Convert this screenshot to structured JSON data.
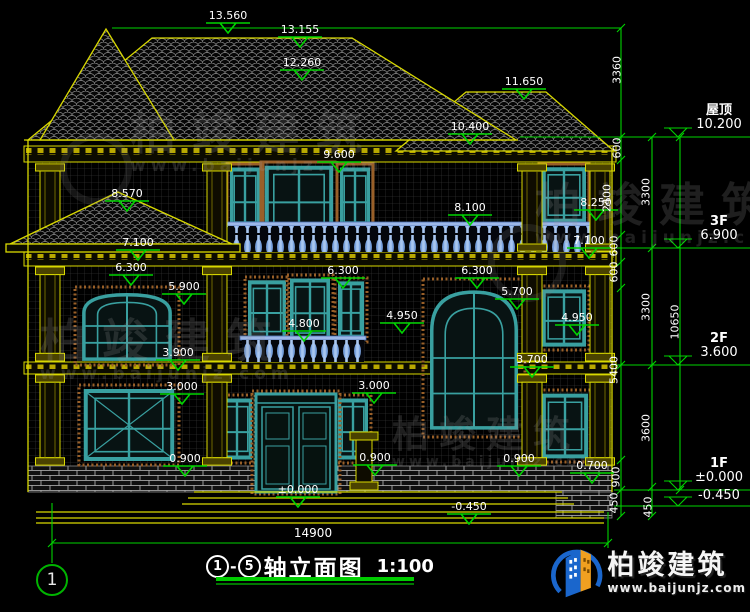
{
  "title_block": {
    "axis_start": "1",
    "axis_end": "5",
    "axis_separator": "-",
    "title": "轴立面图",
    "scale": "1:100",
    "axis_bubble": "1",
    "overall_width_dim": "14900"
  },
  "brand": {
    "name": "柏竣建筑",
    "website": "www.baijunjz.com"
  },
  "watermark": {
    "name": "柏竣建筑",
    "website": "www.baijunjz.com"
  },
  "levels": [
    {
      "name": "屋顶",
      "value": "10.200",
      "y": 137
    },
    {
      "name": "3F",
      "value": "6.900",
      "y": 248
    },
    {
      "name": "2F",
      "value": "3.600",
      "y": 365
    },
    {
      "name": "1F",
      "value": "±0.000",
      "y": 490
    },
    {
      "name": "",
      "value": "-0.450",
      "y": 506
    }
  ],
  "elevation_markers": [
    {
      "t": "13.560",
      "x": 228,
      "y": 10
    },
    {
      "t": "13.155",
      "x": 300,
      "y": 24
    },
    {
      "t": "12.260",
      "x": 302,
      "y": 57
    },
    {
      "t": "11.650",
      "x": 524,
      "y": 76
    },
    {
      "t": "10.400",
      "x": 470,
      "y": 121
    },
    {
      "t": "9.600",
      "x": 339,
      "y": 149
    },
    {
      "t": "8.570",
      "x": 127,
      "y": 188
    },
    {
      "t": "8.250",
      "x": 596,
      "y": 197
    },
    {
      "t": "8.100",
      "x": 470,
      "y": 202
    },
    {
      "t": "7.100",
      "x": 138,
      "y": 237
    },
    {
      "t": "7.100",
      "x": 589,
      "y": 235
    },
    {
      "t": "6.300",
      "x": 131,
      "y": 262
    },
    {
      "t": "6.300",
      "x": 343,
      "y": 265
    },
    {
      "t": "6.300",
      "x": 477,
      "y": 265
    },
    {
      "t": "5.900",
      "x": 184,
      "y": 281
    },
    {
      "t": "5.700",
      "x": 517,
      "y": 286
    },
    {
      "t": "4.950",
      "x": 402,
      "y": 310
    },
    {
      "t": "4.950",
      "x": 577,
      "y": 312
    },
    {
      "t": "4.800",
      "x": 304,
      "y": 318
    },
    {
      "t": "3.900",
      "x": 178,
      "y": 347
    },
    {
      "t": "3.700",
      "x": 532,
      "y": 354
    },
    {
      "t": "3.000",
      "x": 182,
      "y": 381
    },
    {
      "t": "3.000",
      "x": 374,
      "y": 380
    },
    {
      "t": "0.900",
      "x": 185,
      "y": 453
    },
    {
      "t": "0.900",
      "x": 375,
      "y": 452
    },
    {
      "t": "0.900",
      "x": 519,
      "y": 453
    },
    {
      "t": "0.700",
      "x": 592,
      "y": 460
    },
    {
      "t": "±0.000",
      "x": 298,
      "y": 484
    },
    {
      "t": "-0.450",
      "x": 469,
      "y": 501
    }
  ],
  "vertical_dims": [
    {
      "t": "3360",
      "x": 617,
      "y": 70
    },
    {
      "t": "600",
      "x": 617,
      "y": 148
    },
    {
      "t": "2400",
      "x": 607,
      "y": 198
    },
    {
      "t": "3300",
      "x": 646,
      "y": 192
    },
    {
      "t": "600",
      "x": 614,
      "y": 246
    },
    {
      "t": "600",
      "x": 614,
      "y": 272
    },
    {
      "t": "3300",
      "x": 646,
      "y": 307
    },
    {
      "t": "10650",
      "x": 675,
      "y": 322
    },
    {
      "t": "5400",
      "x": 614,
      "y": 370
    },
    {
      "t": "3600",
      "x": 646,
      "y": 428
    },
    {
      "t": "900",
      "x": 616,
      "y": 477
    },
    {
      "t": "450",
      "x": 614,
      "y": 503
    },
    {
      "t": "450",
      "x": 648,
      "y": 507
    }
  ],
  "colors": {
    "background": "#000000",
    "cad_yellow": "#d9d900",
    "dim_green": "#00d400",
    "text_white": "#ffffff",
    "window_teal": "#39a0a0",
    "baluster_blue": "#7aa3e0",
    "brick_mortar": "#bdbdbd",
    "logo_blue": "#1a66cc",
    "logo_orange": "#f0a020",
    "title_underline_green": "#00cc00"
  }
}
